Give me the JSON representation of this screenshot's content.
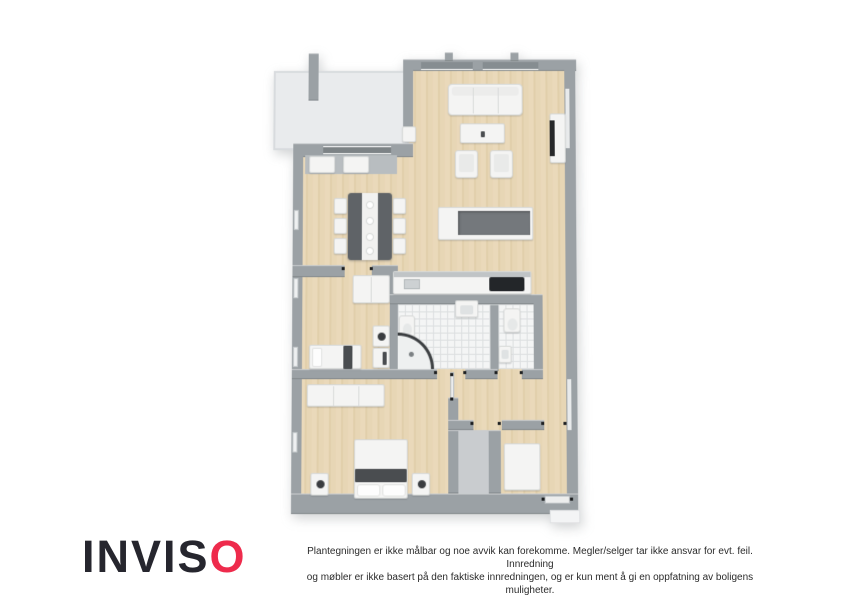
{
  "branding": {
    "logo_prefix": "INVIS",
    "logo_accent_letter": "O",
    "logo_color_dark": "#26262e",
    "logo_color_accent": "#ee2b4c"
  },
  "footer": {
    "disclaimer_line1": "Plantegningen er ikke målbar og noe avvik kan forekomme. Megler/selger tar ikke ansvar for evt. feil. Innredning",
    "disclaimer_line2": "og møbler er ikke basert på den faktiske innredningen, og er kun ment å gi en oppfatning av boligens muligheter."
  },
  "floorplan": {
    "type": "3d-top-view-floor-plan",
    "colors": {
      "wall": "#9ba1a5",
      "wood_floor": "#e7d6b4",
      "bathroom_tile": "#f4f5f5",
      "balcony_floor": "#e9ebed",
      "storage_floor": "#c9cccf",
      "dark_furniture": "#4a4d50"
    },
    "rooms": [
      "balcony",
      "living-room",
      "dining-area",
      "kitchen",
      "small-bedroom",
      "bathroom",
      "wc",
      "master-bedroom",
      "hallway",
      "storage",
      "entry-closet"
    ]
  }
}
